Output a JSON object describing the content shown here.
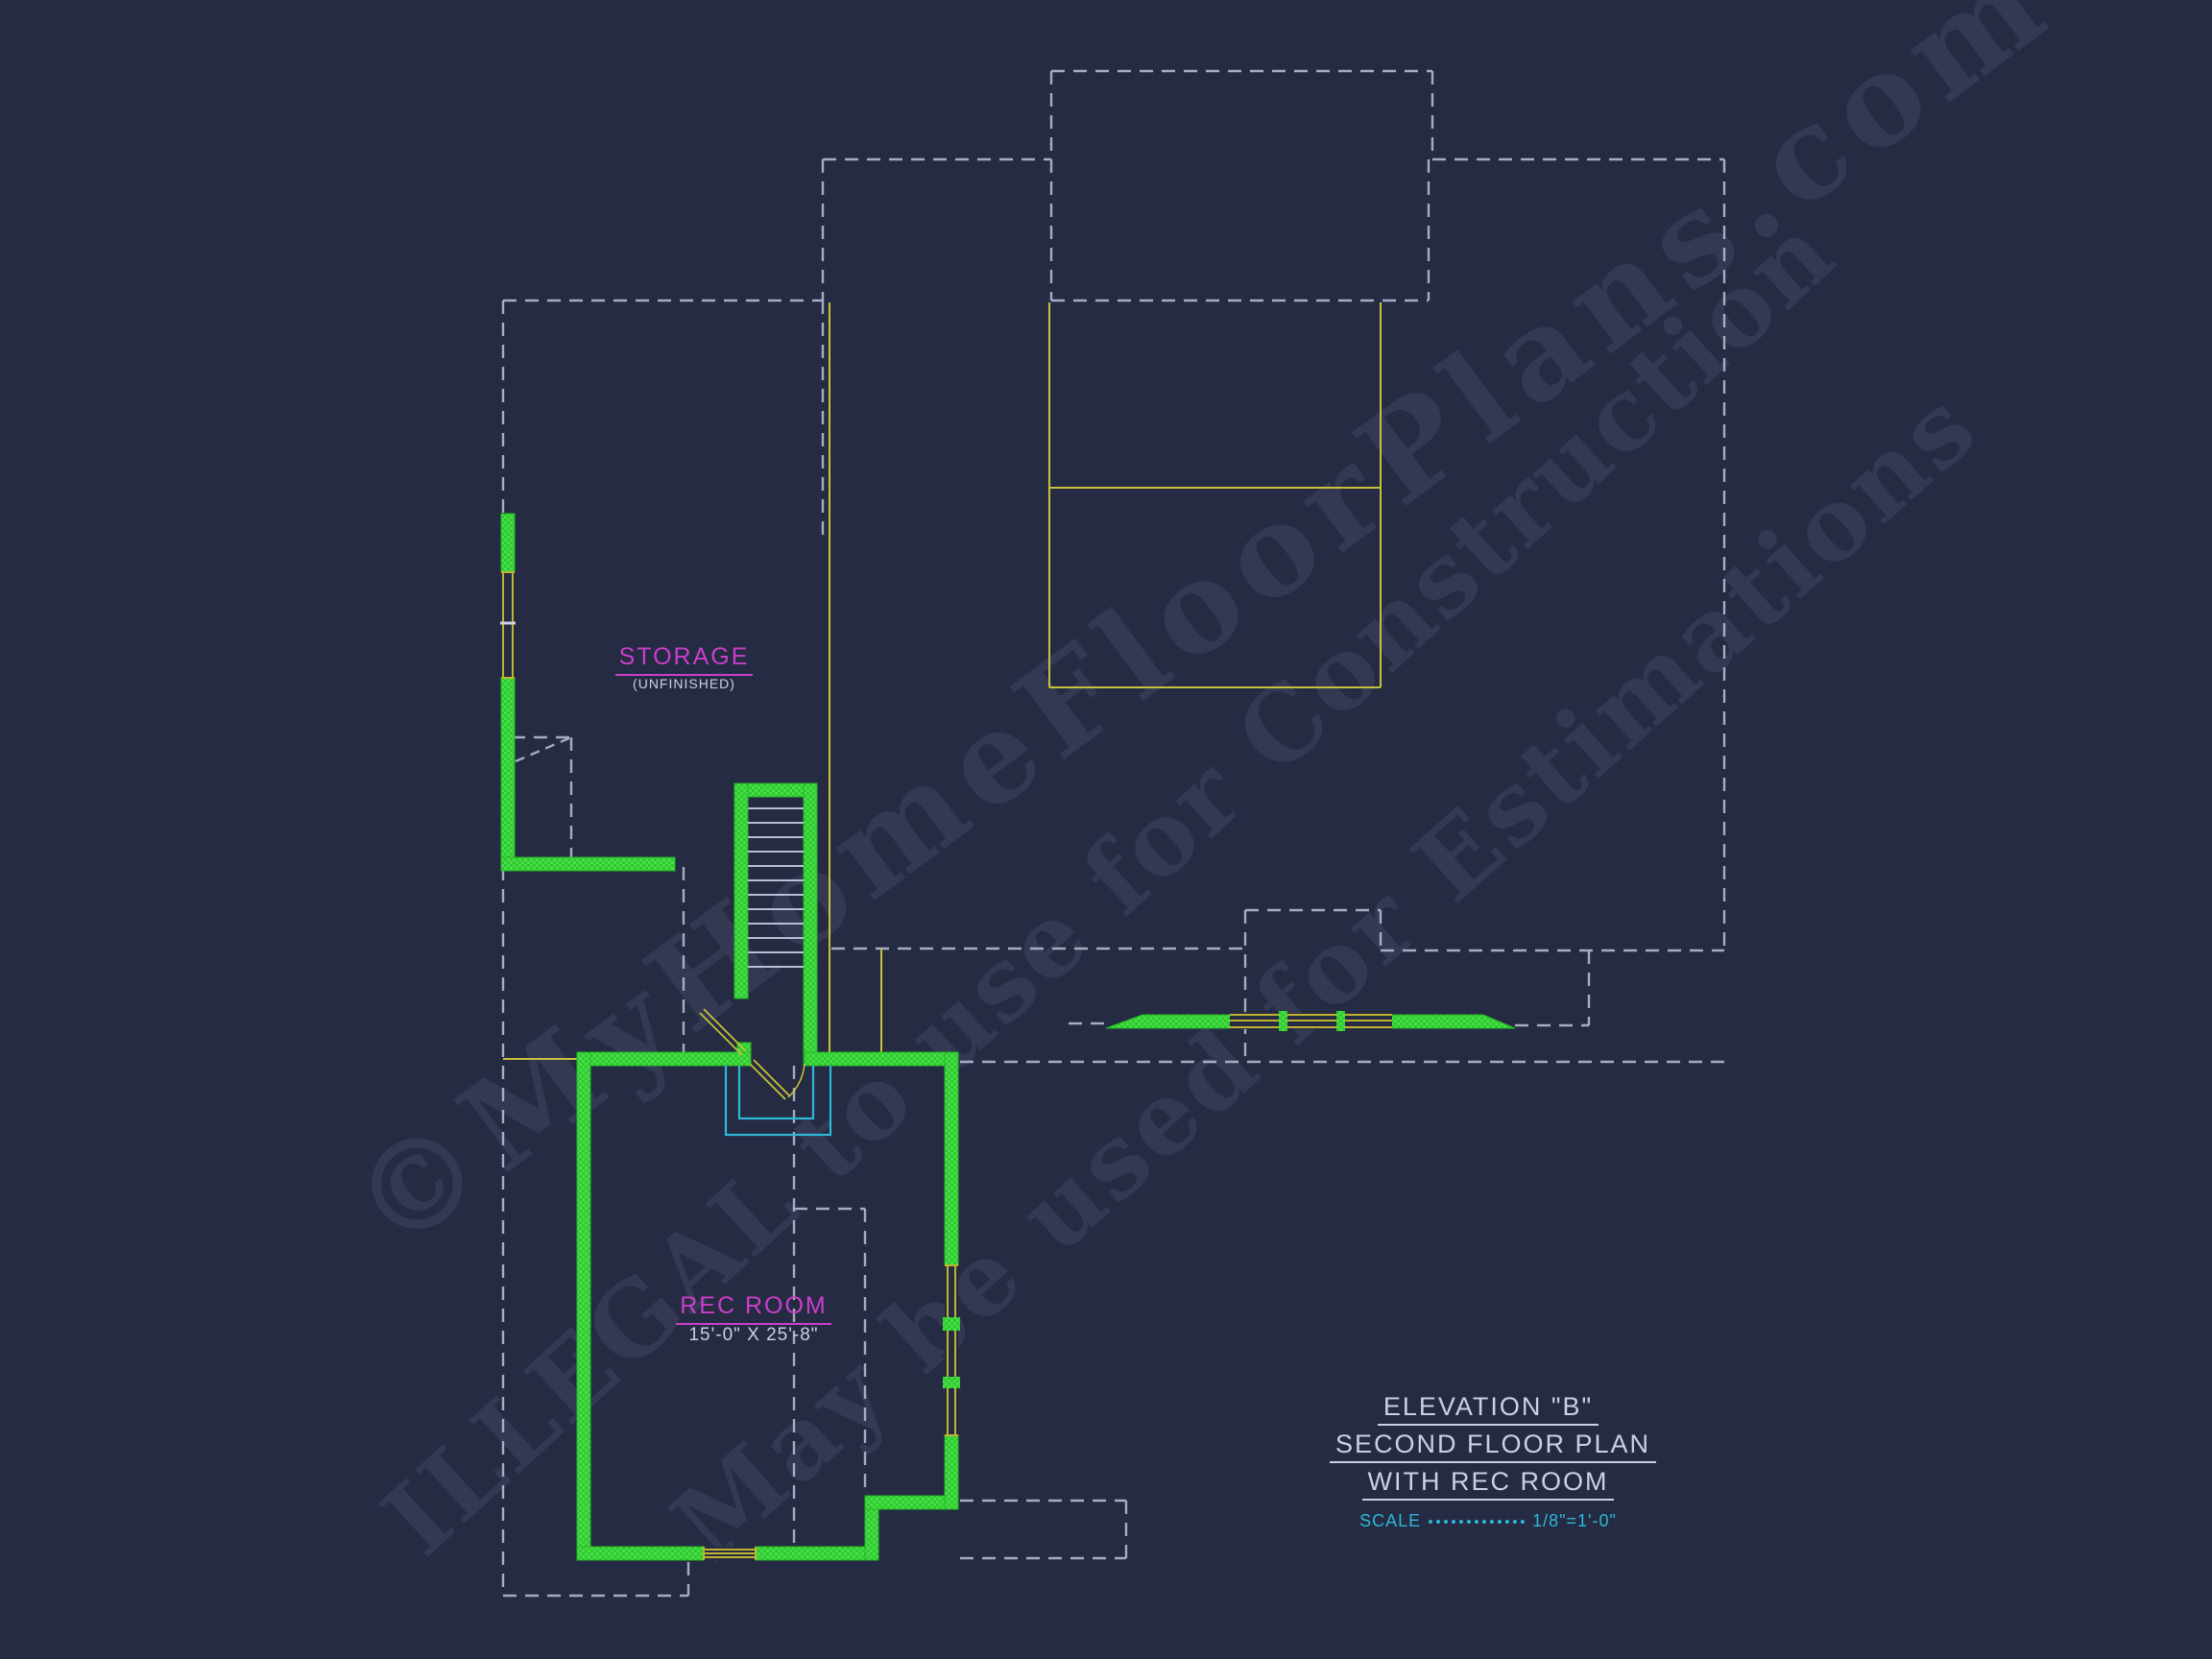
{
  "plan": {
    "type": "architectural-floor-plan",
    "colors": {
      "background": "#252b42",
      "wall_green": "#33d433",
      "window_yellow": "#c9c13c",
      "roofline_dash_gray": "#a6adc2",
      "stair_opening_cyan": "#2cb8d8",
      "label_magenta": "#cb3ecb",
      "text_lavender": "#ccd0e6"
    },
    "labels": {
      "storage": {
        "title": "STORAGE",
        "subtitle": "(UNFINISHED)"
      },
      "rec_room": {
        "title": "REC ROOM",
        "dimensions": "15'-0\" X 25'-8\""
      }
    },
    "title_block": {
      "line1": "ELEVATION \"B\"",
      "line2": "SECOND FLOOR PLAN",
      "line3": "WITH REC ROOM",
      "scale_label": "SCALE",
      "scale_value": "1/8\"=1'-0\""
    },
    "watermark": {
      "line1": "©MyHomeFloorPlans.com",
      "line2": "ILLEGAL to use for Construction",
      "line3": "May be used for Estimations"
    }
  }
}
